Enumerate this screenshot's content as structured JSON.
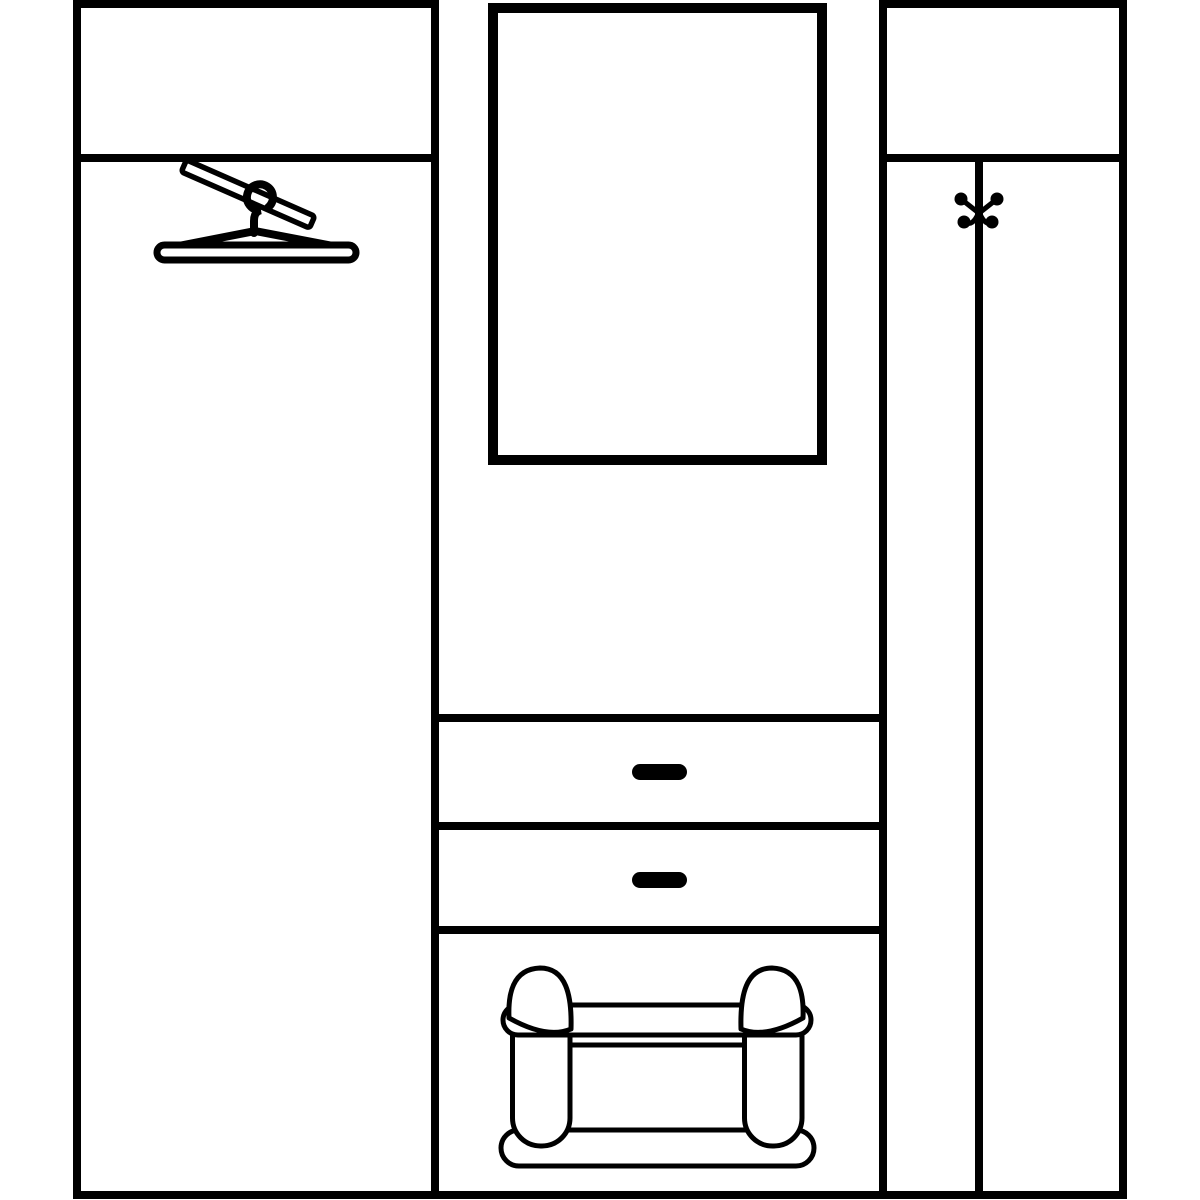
{
  "colors": {
    "background": "#ffffff",
    "ink": "#000000"
  },
  "diagram": {
    "type": "furniture-line-drawing",
    "subject": "hallway-wardrobe-set-front-elevation",
    "components": [
      {
        "id": "left-cabinet",
        "sections": [
          "top-shelf-compartment",
          "wardrobe-compartment"
        ],
        "icon": "clothes-hanger-on-rail-icon"
      },
      {
        "id": "center-panel-unit",
        "sections": [
          "mirror",
          "open-shelf-space",
          "drawer-top",
          "drawer-bottom",
          "bench-compartment"
        ],
        "drawer_count": 2,
        "handle_style": "solid-black-bar",
        "icon": "bench-with-bolster-cushions-icon"
      },
      {
        "id": "right-cabinet",
        "sections": [
          "top-shelf-compartment",
          "split-lower-compartment"
        ],
        "icon": "double-coat-hook-icon"
      }
    ]
  }
}
